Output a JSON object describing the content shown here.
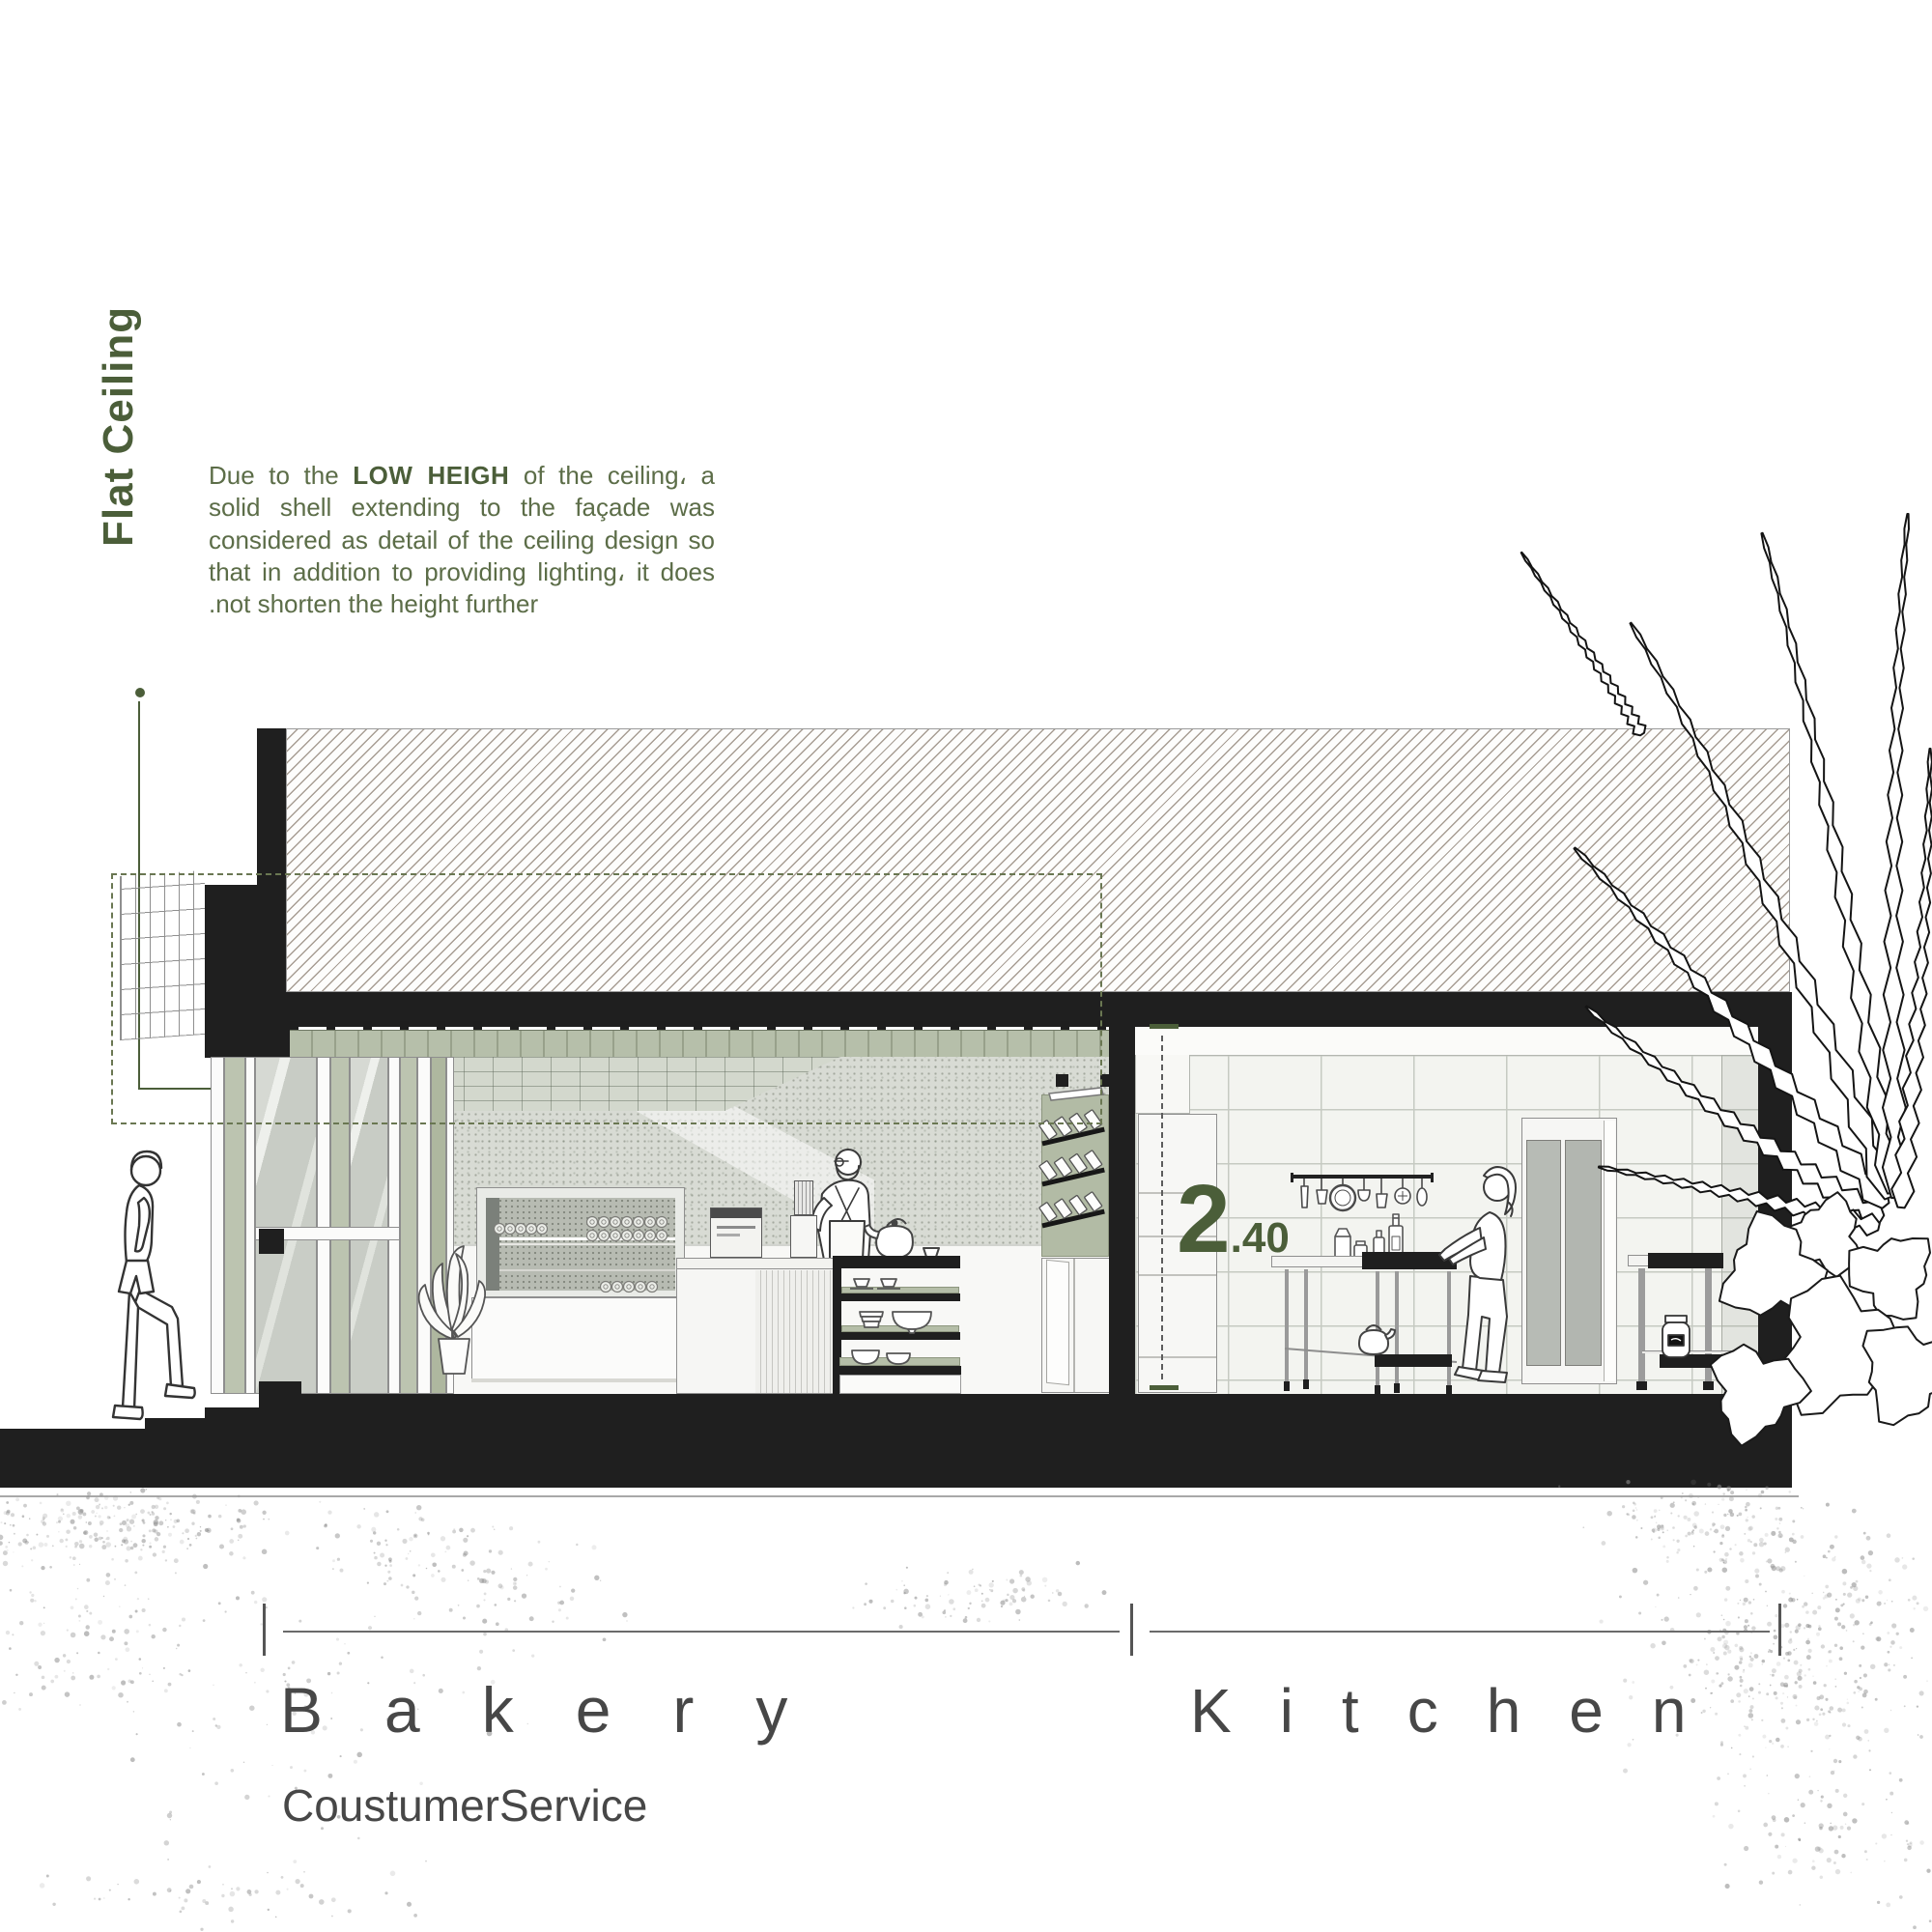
{
  "callout": {
    "title": "Flat Ceiling",
    "body_lead": "Due to the ",
    "body_bold": "LOW HEIGH",
    "body_rest": " of the ceiling، a solid shell extending to the façade was considered as detail of the ceiling design so that in addition to providing lighting، it does .not shorten the height further"
  },
  "dimension": {
    "integer": "2",
    "decimal": ".40"
  },
  "room_labels": {
    "bakery_title": "Bakery",
    "bakery_subtitle": "CoustumerService",
    "kitchen_title": "Kitchen"
  },
  "colors": {
    "accent_green": "#4b5e39",
    "text_green": "#5c6d48",
    "ink": "#1f1f1f",
    "sage": "#b5bea8",
    "label_gray": "#474747"
  }
}
